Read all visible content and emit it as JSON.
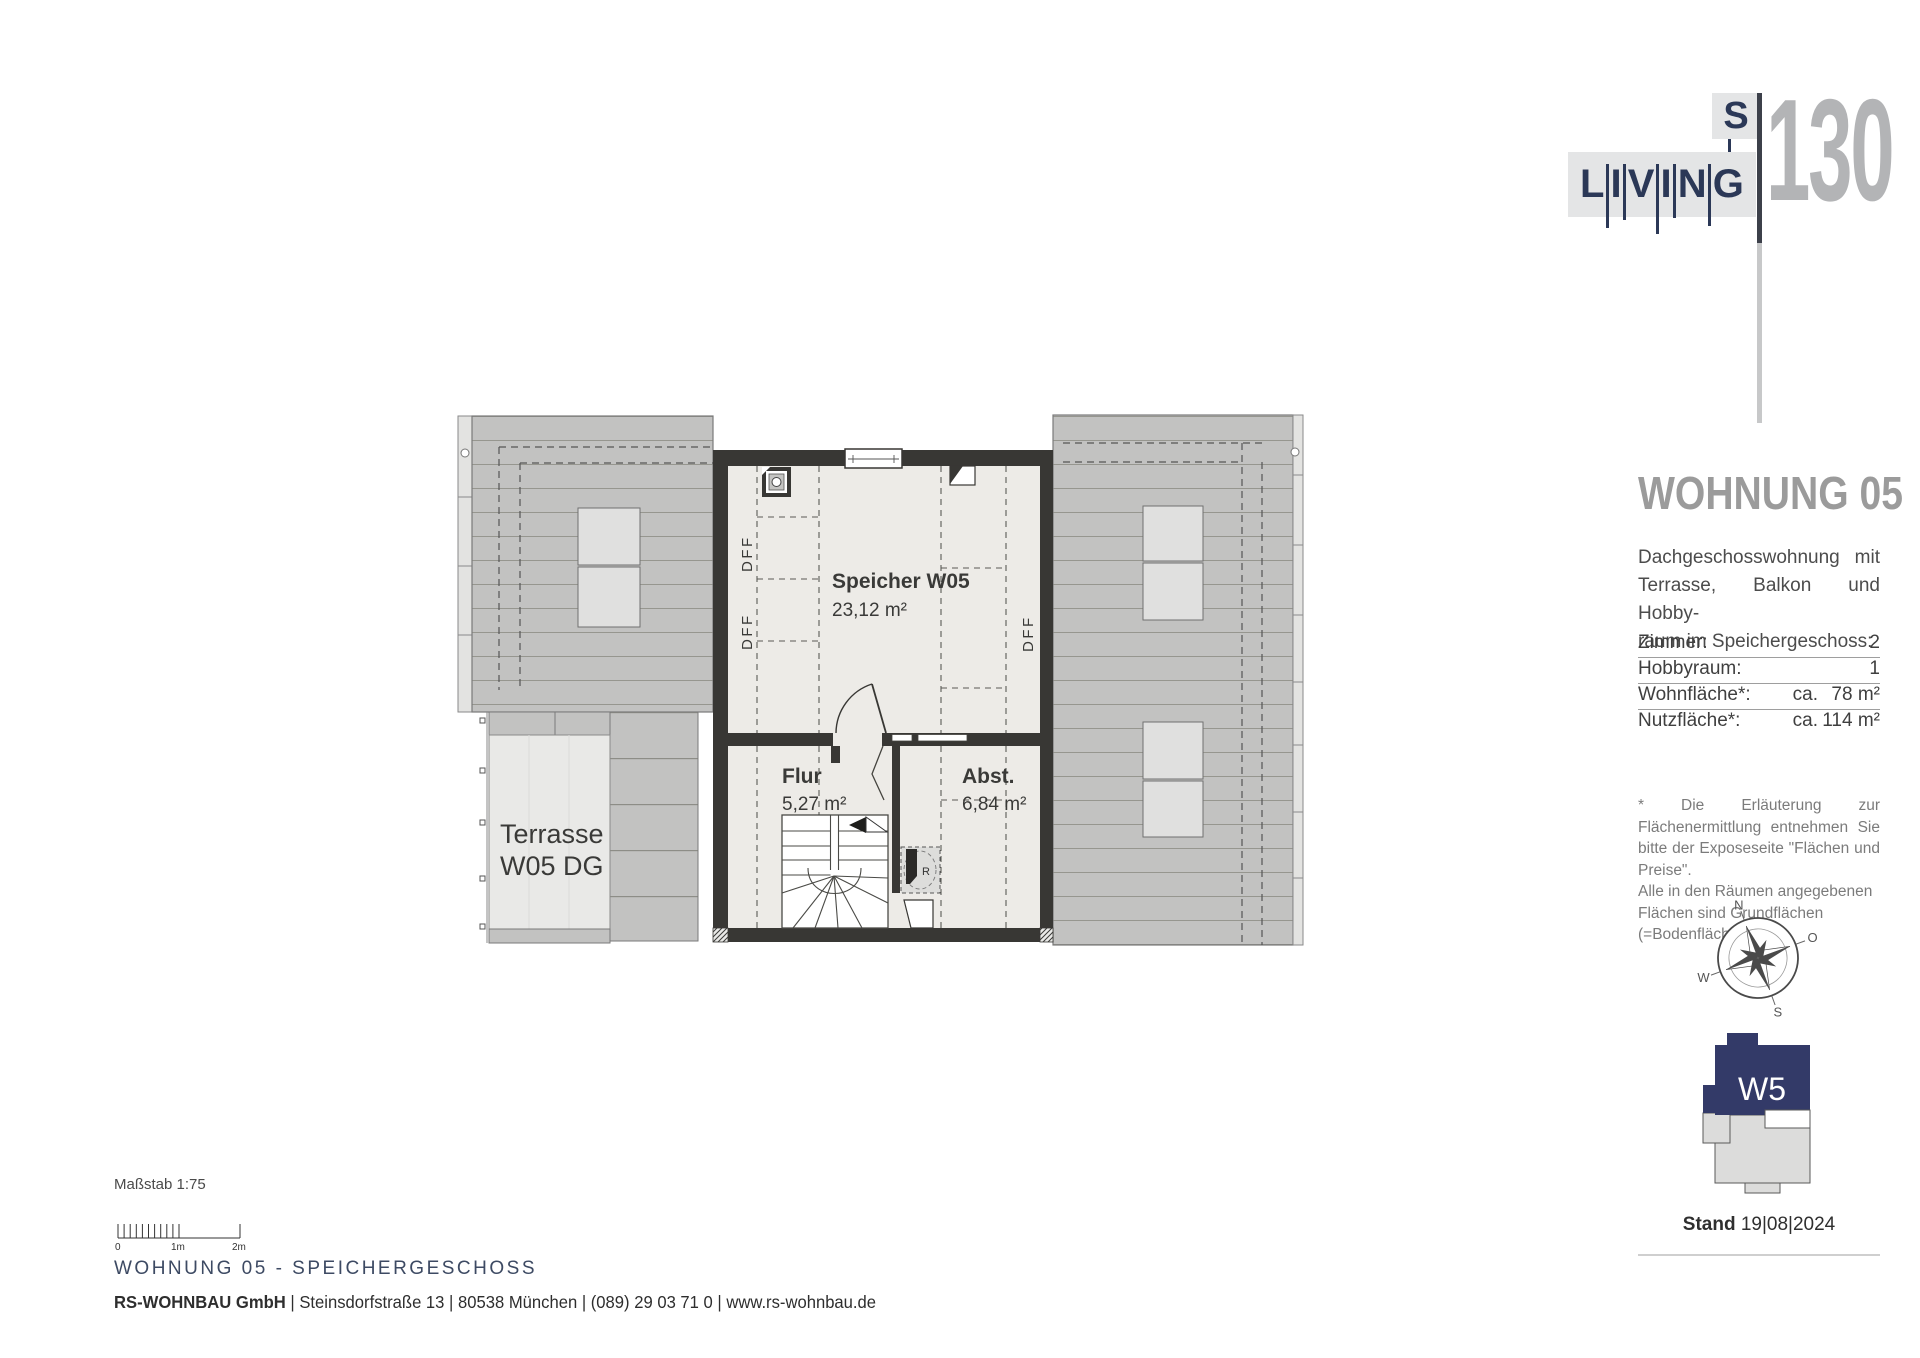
{
  "logo": {
    "letters": [
      "L",
      "I",
      "V",
      "I",
      "N",
      "G"
    ],
    "s": "S",
    "number": "130"
  },
  "sidebar": {
    "title": "WOHNUNG 05",
    "desc_line1": "Dachgeschosswohnung mit",
    "desc_line2": "Terrasse, Balkon und Hobby-",
    "desc_line3": "raum im Speichergeschoss:",
    "table": {
      "rows": [
        {
          "label": "Zimmer:",
          "ca": "",
          "value": "2"
        },
        {
          "label": "Hobbyraum:",
          "ca": "",
          "value": "1"
        },
        {
          "label": "Wohnfläche*:",
          "ca": "ca.",
          "value": "78 m²"
        },
        {
          "label": "Nutzfläche*:",
          "ca": "ca.",
          "value": "114 m²"
        }
      ]
    },
    "footnote_para1": "* Die Erläuterung zur Flächenermittlung entnehmen Sie bitte der Exposeseite \"Flächen und Preise\".",
    "footnote_para2": "Alle in den Räumen angegebenen Flächen sind Grundflächen (=Bodenflächen).",
    "compass": {
      "n": "N",
      "o": "O",
      "s": "S",
      "w": "W"
    },
    "building_label": "W5",
    "stand_label": "Stand",
    "stand_date": "19|08|2024"
  },
  "plan": {
    "rooms": [
      {
        "name": "Speicher W05",
        "area": "23,12 m²"
      },
      {
        "name": "Flur",
        "area": "5,27 m²"
      },
      {
        "name": "Abst.",
        "area": "6,84 m²"
      }
    ],
    "terrace_line1": "Terrasse",
    "terrace_line2": "W05 DG",
    "dff": "DFF",
    "shaft_label": "R"
  },
  "scale": {
    "label": "Maßstab 1:75",
    "tick0": "0",
    "tick1": "1m",
    "tick2": "2m"
  },
  "footer": {
    "headline": "WOHNUNG 05 - SPEICHERGESCHOSS",
    "company": "RS-WOHNBAU GmbH",
    "rest": " | Steinsdorfstraße 13 |  80538 München | (089) 29 03 71 0 | www.rs-wohnbau.de"
  },
  "colors": {
    "brand_navy": "#2b3857",
    "logo_number_gray": "#b3b4b6",
    "heading_gray": "#9b9b9b",
    "wall_dark": "#383734",
    "roof_gray": "#c2c2c1",
    "room_fill": "#edebe7",
    "building_icon_navy": "#333a68",
    "footer_navy": "#3d4a63"
  }
}
